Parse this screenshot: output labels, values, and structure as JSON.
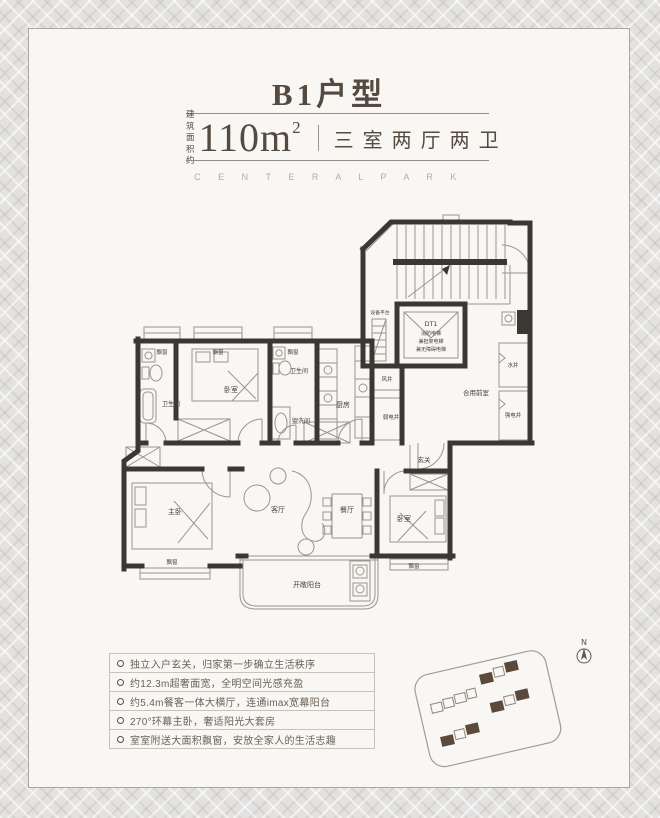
{
  "header": {
    "title": "B1户型",
    "area_prefix_top": "建 筑",
    "area_prefix_bottom": "面积约",
    "area_value": "110m",
    "area_superscript": "2",
    "unit_layout": "三室两厅两卫",
    "brand_caption": "C E N T E R A L   P A R K"
  },
  "floor_plan": {
    "rooms": {
      "bay_window": "飘窗",
      "bedroom": "卧室",
      "bathroom": "卫生间",
      "washroom": "盥洗间",
      "kitchen": "厨房",
      "wind_shaft": "风井",
      "weak_electric_shaft": "弱电井",
      "strong_electric_shaft": "强电井",
      "water_shaft": "水井",
      "shared_front_room": "合用前室",
      "equipment_platform": "设备平台",
      "entry": "玄关",
      "master_bedroom": "主卧",
      "living_room": "客厅",
      "dining_room": "餐厅",
      "open_balcony": "开敞阳台"
    },
    "elevator": {
      "name": "DT1",
      "line2": "消防电梯",
      "line3": "兼担架电梯",
      "line4": "兼无障碍电梯"
    }
  },
  "features": {
    "items": [
      "独立入户玄关，归家第一步确立生活秩序",
      "约12.3m超奢面宽，全明空间光感充盈",
      "约5.4m餐客一体大横厅，连通imax宽幕阳台",
      "270°环幕主卧，奢适阳光大套房",
      "室室附送大面积飘窗，安放全家人的生活志趣"
    ]
  },
  "site_plan": {
    "compass_label": "N",
    "highlight_color": "#5b4a3c"
  },
  "colors": {
    "accent_text": "#554a40",
    "wall": "#3b3833",
    "caption": "#b4aba0",
    "feature_text": "#6b6156"
  }
}
